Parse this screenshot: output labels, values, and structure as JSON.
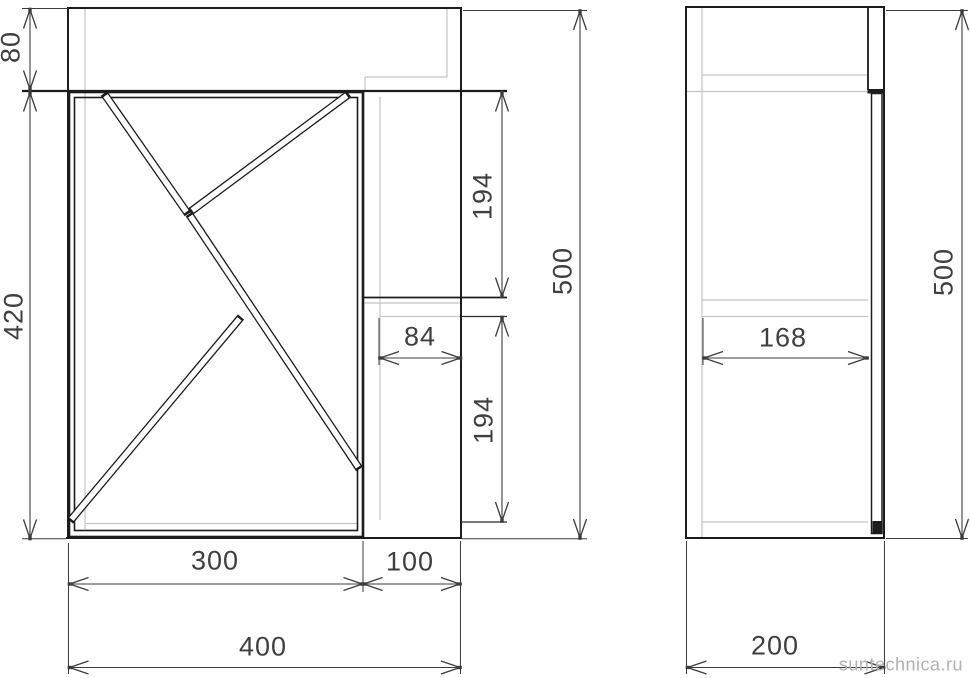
{
  "front_view": {
    "dims": {
      "height_top": "80",
      "height_door": "420",
      "height_total": "500",
      "gap_upper": "194",
      "shelf_depth": "84",
      "gap_lower": "194",
      "width_door": "300",
      "width_side": "100",
      "width_total": "400"
    }
  },
  "side_view": {
    "dims": {
      "width_inner": "168",
      "height_total": "500",
      "depth_total": "200"
    }
  },
  "watermark": {
    "text": "suntechnica.ru"
  },
  "colors": {
    "line_main": "#1c1c1c",
    "line_dim": "#3c3c3c",
    "line_construction": "#c4c4c4",
    "watermark": "#b2b2b2",
    "background": "#ffffff"
  }
}
